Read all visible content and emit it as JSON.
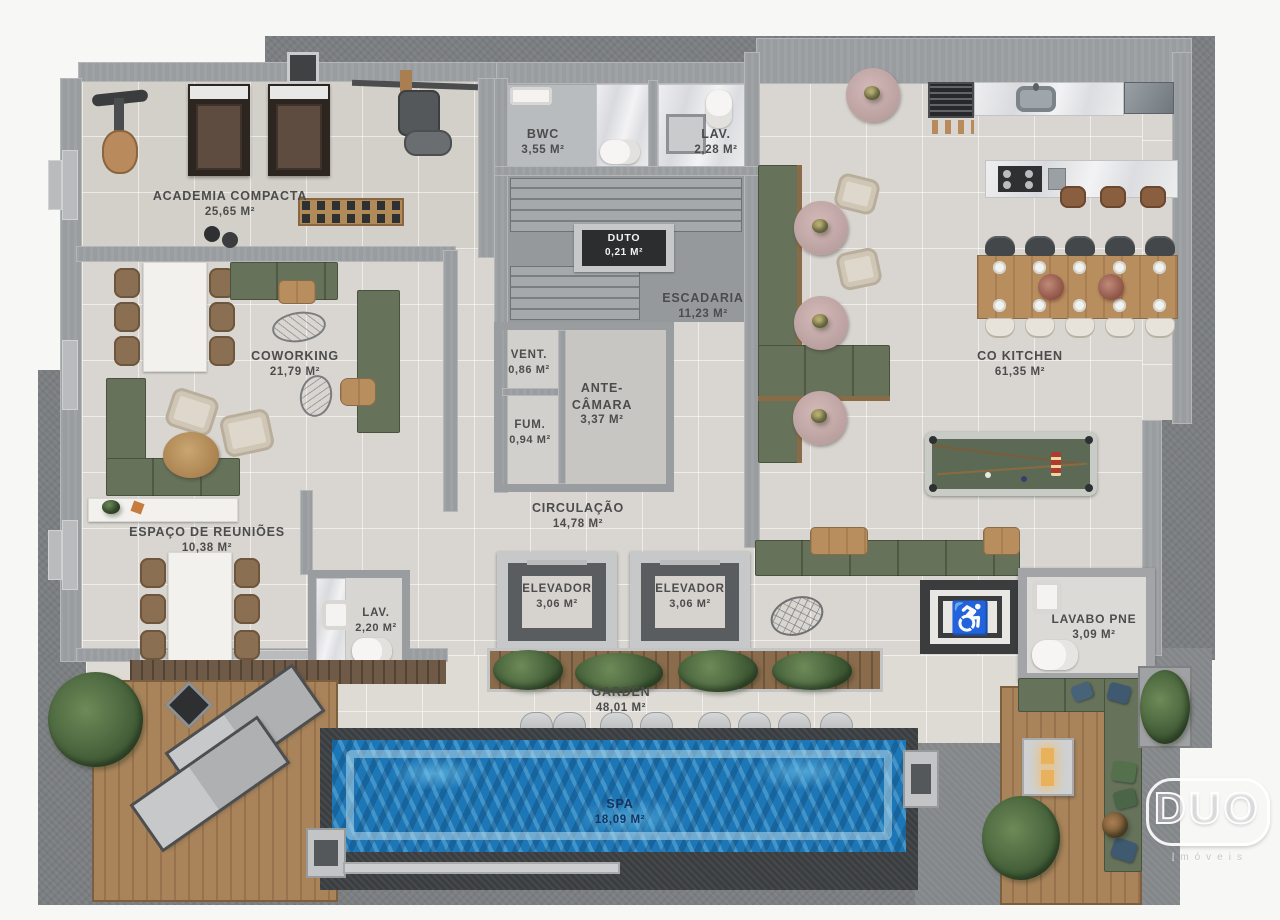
{
  "brand": {
    "name": "DUO",
    "tagline": "imóveis"
  },
  "rooms": {
    "academia": {
      "name": "ACADEMIA COMPACTA",
      "area": "25,65 M²"
    },
    "bwc": {
      "name": "BWC",
      "area": "3,55 M²"
    },
    "lav_top": {
      "name": "LAV.",
      "area": "2,28 M²"
    },
    "duto": {
      "name": "DUTO",
      "area": "0,21 M²"
    },
    "escadaria": {
      "name": "ESCADARIA",
      "area": "11,23 M²"
    },
    "vent": {
      "name": "VENT.",
      "area": "0,86 M²"
    },
    "antecamara": {
      "name": "ANTE-CÂMARA",
      "area": "3,37 M²"
    },
    "fum": {
      "name": "FUM.",
      "area": "0,94 M²"
    },
    "coworking": {
      "name": "COWORKING",
      "area": "21,79 M²"
    },
    "cokitchen": {
      "name": "CO KITCHEN",
      "area": "61,35 M²"
    },
    "circulacao": {
      "name": "CIRCULAÇÃO",
      "area": "14,78 M²"
    },
    "reunioes": {
      "name": "ESPAÇO DE REUNIÕES",
      "area": "10,38 M²"
    },
    "lav_meeting": {
      "name": "LAV.",
      "area": "2,20 M²"
    },
    "elevador": {
      "name": "ELEVADOR",
      "area": "3,06 M²"
    },
    "lavabo_pne": {
      "name": "LAVABO PNE",
      "area": "3,09 M²"
    },
    "garden": {
      "name": "GARDEN",
      "area": "48,01 M²"
    },
    "spa": {
      "name": "SPA",
      "area": "18,09 M²"
    }
  },
  "icons": {
    "accessibility": "♿"
  },
  "colors": {
    "water": "#1d76b5",
    "sofa_green": "#66725a",
    "deck_wood": "#a9845b",
    "apron": "#7b7e81",
    "floor": "#d9d6d1",
    "label_text": "#4c4c4c"
  }
}
